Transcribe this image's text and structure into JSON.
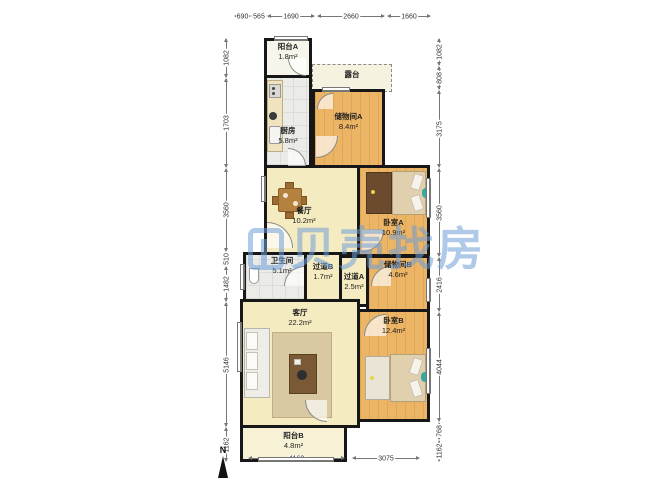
{
  "watermark": {
    "text": "贝壳找房"
  },
  "compass": {
    "north_label": "N"
  },
  "rooms": [
    {
      "name": "阳台A",
      "area": "1.8m²"
    },
    {
      "name": "厨房",
      "area": "5.8m²"
    },
    {
      "name": "露台",
      "area": ""
    },
    {
      "name": "储物间A",
      "area": "8.4m²"
    },
    {
      "name": "餐厅",
      "area": "10.2m²"
    },
    {
      "name": "卧室A",
      "area": "10.9m²"
    },
    {
      "name": "卫生间",
      "area": "5.1m²"
    },
    {
      "name": "过道B",
      "area": "1.7m²"
    },
    {
      "name": "过道A",
      "area": "2.5m²"
    },
    {
      "name": "储物间B",
      "area": "4.6m²"
    },
    {
      "name": "客厅",
      "area": "22.2m²"
    },
    {
      "name": "卧室B",
      "area": "12.4m²"
    },
    {
      "name": "阳台B",
      "area": "4.8m²"
    }
  ],
  "dimensions": {
    "top": [
      "690",
      "565",
      "1690",
      "2660",
      "1660"
    ],
    "bottom": [
      "4160",
      "3075"
    ],
    "left": [
      "1082",
      "1703",
      "3560",
      "510",
      "1482",
      "5146",
      "1162"
    ],
    "right": [
      "1082",
      "808",
      "3175",
      "3560",
      "2416",
      "4044",
      "768",
      "1162"
    ]
  },
  "colors": {
    "wall": "#171717",
    "wood_floor": "#ecb465",
    "cream_floor": "#f5ebc0",
    "tile_floor": "#ebebe8",
    "watermark_blue": "#6f9fd8"
  }
}
